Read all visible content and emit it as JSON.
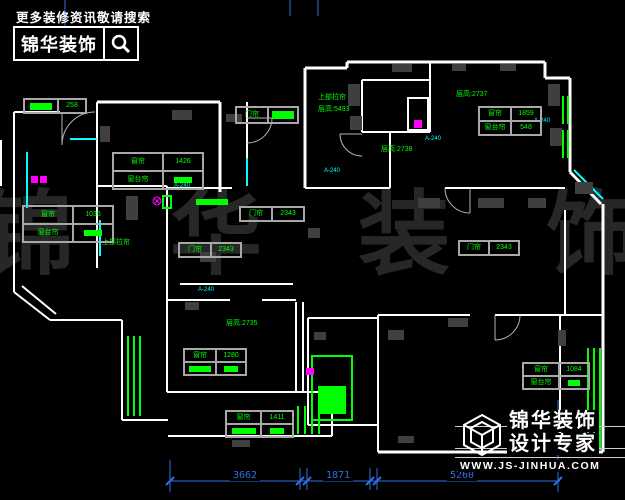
{
  "header_logo": {
    "tagline": "更多装修资讯敬请搜索",
    "brand": "锦华装饰"
  },
  "footer_logo": {
    "brand": "锦华装饰",
    "subtitle": "设计专家",
    "website": "WWW.JS-JINHUA.COM"
  },
  "watermark": "锦华装饰",
  "colors": {
    "wall": "#ffffff",
    "window": "#00ffff",
    "annotation": "#00ff00",
    "dimension": "#2e6fe0",
    "marker": "#ff00ff",
    "watermark": "#272727"
  },
  "plan": {
    "texts": [
      {
        "t": "上部拉帘"
      },
      {
        "t": "层高:5493"
      },
      {
        "t": "层高:2737"
      },
      {
        "t": "层高:2738"
      },
      {
        "t": "层高:2735"
      },
      {
        "t": "上部拉帘"
      },
      {
        "t": "A-240"
      },
      {
        "t": "A-240"
      },
      {
        "t": "A-240"
      },
      {
        "t": "A-240"
      },
      {
        "t": "A-240"
      }
    ],
    "tables": {
      "a": {
        "r1l": "窗帘",
        "r1v": "1426",
        "r2l": "窗台帘"
      },
      "b": {
        "r1l": "窗帘",
        "r1v": "1035",
        "r2l": "窗台帘"
      },
      "c": {
        "r1l": "窗帘",
        "r1v": "1859",
        "r2l": "窗台帘",
        "r2v": "548"
      },
      "d": {
        "r1l": "窗帘",
        "r1v": "1280"
      },
      "e": {
        "r1l": "窗帘",
        "r1v": "1411"
      },
      "f": {
        "r1l": "窗帘",
        "r1v": "1084",
        "r2l": "窗台帘"
      }
    },
    "door_labels": {
      "d1": {
        "l": "门帘",
        "v": "2343"
      },
      "d2": {
        "l": "门帘",
        "v": "2343"
      },
      "d3": {
        "l": "门帘",
        "v": "2343"
      },
      "d4": {
        "l": "门帘"
      }
    },
    "marker_258": "258",
    "dims": [
      "3662",
      "1871",
      "5260"
    ]
  }
}
